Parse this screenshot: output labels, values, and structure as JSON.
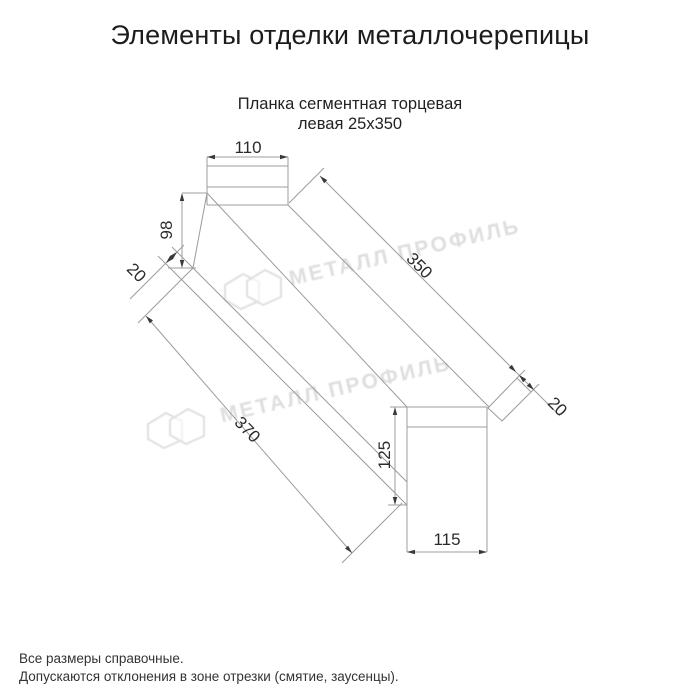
{
  "page": {
    "title": "Элементы отделки металлочерепицы"
  },
  "product": {
    "subtitle_line1": "Планка сегментная торцевая",
    "subtitle_line2": "левая 25х350"
  },
  "drawing": {
    "type": "technical-drawing",
    "dimensions": {
      "flange_width": "110",
      "left_end_height": "98",
      "left_hem_fold": "20",
      "top_edge_length": "350",
      "bottom_edge_length": "370",
      "end_fold": "20",
      "end_face_height": "125",
      "end_face_width": "115"
    }
  },
  "watermark": {
    "brand_text": "МЕТАЛЛ ПРОФИЛЬ"
  },
  "footer": {
    "note_line1": "Все размеры справочные.",
    "note_line2": "Допускаются отклонения в зоне отрезки (смятие, заусенцы)."
  },
  "colors": {
    "background": "#ffffff",
    "drawing_line": "#9c9c9c",
    "arrow": "#3a3a3a",
    "dimension_text": "#2b2b2b",
    "watermark": "#d9d9d9"
  }
}
